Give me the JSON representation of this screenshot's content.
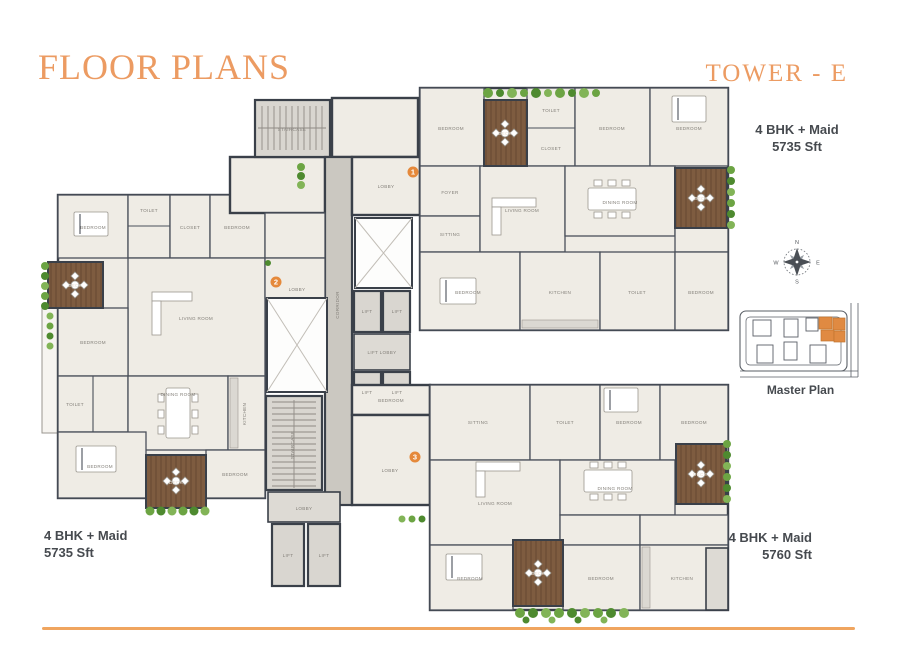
{
  "page": {
    "title": "FLOOR PLANS",
    "tower_title": "TOWER - E"
  },
  "unit_labels": {
    "top_right": {
      "type": "4 BHK + Maid",
      "area": "5735 Sft"
    },
    "bottom_left": {
      "type": "4 BHK + Maid",
      "area": "5735 Sft"
    },
    "bottom_right": {
      "type": "4 BHK + Maid",
      "area": "5760 Sft"
    }
  },
  "master_plan": {
    "caption": "Master Plan"
  },
  "compass": {
    "north": "N",
    "east": "E",
    "south": "S",
    "west": "W"
  },
  "plan": {
    "unit_markers": [
      {
        "label": "1",
        "x": 413,
        "y": 172
      },
      {
        "label": "2",
        "x": 276,
        "y": 282
      },
      {
        "label": "3",
        "x": 415,
        "y": 457
      }
    ],
    "room_labels": [
      {
        "t": "STAIRCASE",
        "x": 292,
        "y": 131
      },
      {
        "t": "CORRIDOR",
        "x": 339,
        "y": 305,
        "r": -90
      },
      {
        "t": "LOBBY",
        "x": 386,
        "y": 188
      },
      {
        "t": "LIFT",
        "x": 367,
        "y": 313
      },
      {
        "t": "LIFT",
        "x": 397,
        "y": 313
      },
      {
        "t": "LIFT LOBBY",
        "x": 382,
        "y": 354
      },
      {
        "t": "LIFT",
        "x": 367,
        "y": 394
      },
      {
        "t": "LIFT",
        "x": 397,
        "y": 394
      },
      {
        "t": "LOBBY",
        "x": 297,
        "y": 291
      },
      {
        "t": "STAIRCASE",
        "x": 294,
        "y": 445,
        "r": -90
      },
      {
        "t": "LOBBY",
        "x": 304,
        "y": 510
      },
      {
        "t": "LIFT",
        "x": 288,
        "y": 557
      },
      {
        "t": "LIFT",
        "x": 324,
        "y": 557
      },
      {
        "t": "LOBBY",
        "x": 390,
        "y": 472
      },
      {
        "t": "BEDROOM",
        "x": 451,
        "y": 130
      },
      {
        "t": "DECK",
        "x": 505,
        "y": 135,
        "s": "onwood"
      },
      {
        "t": "TOILET",
        "x": 551,
        "y": 112
      },
      {
        "t": "CLOSET",
        "x": 551,
        "y": 150
      },
      {
        "t": "BEDROOM",
        "x": 612,
        "y": 130
      },
      {
        "t": "BEDROOM",
        "x": 689,
        "y": 130
      },
      {
        "t": "FOYER",
        "x": 450,
        "y": 194
      },
      {
        "t": "SITTING",
        "x": 450,
        "y": 236
      },
      {
        "t": "LIVING ROOM",
        "x": 522,
        "y": 212
      },
      {
        "t": "DINING ROOM",
        "x": 620,
        "y": 204
      },
      {
        "t": "DECK",
        "x": 701,
        "y": 200,
        "s": "onwood"
      },
      {
        "t": "BEDROOM",
        "x": 468,
        "y": 294
      },
      {
        "t": "KITCHEN",
        "x": 560,
        "y": 294
      },
      {
        "t": "TOILET",
        "x": 637,
        "y": 294
      },
      {
        "t": "BEDROOM",
        "x": 701,
        "y": 294
      },
      {
        "t": "BEDROOM",
        "x": 93,
        "y": 229
      },
      {
        "t": "TOILET",
        "x": 149,
        "y": 212
      },
      {
        "t": "CLOSET",
        "x": 190,
        "y": 229
      },
      {
        "t": "BEDROOM",
        "x": 237,
        "y": 229
      },
      {
        "t": "DECK",
        "x": 75,
        "y": 287,
        "s": "onwood"
      },
      {
        "t": "LIVING ROOM",
        "x": 196,
        "y": 320
      },
      {
        "t": "BEDROOM",
        "x": 93,
        "y": 344
      },
      {
        "t": "TOILET",
        "x": 75,
        "y": 406
      },
      {
        "t": "DINING ROOM",
        "x": 178,
        "y": 396
      },
      {
        "t": "KITCHEN",
        "x": 246,
        "y": 414,
        "r": -90
      },
      {
        "t": "BEDROOM",
        "x": 100,
        "y": 468
      },
      {
        "t": "DECK",
        "x": 176,
        "y": 484,
        "s": "onwood"
      },
      {
        "t": "BEDROOM",
        "x": 235,
        "y": 476
      },
      {
        "t": "BEDROOM",
        "x": 391,
        "y": 402
      },
      {
        "t": "SITTING",
        "x": 478,
        "y": 424
      },
      {
        "t": "TOILET",
        "x": 565,
        "y": 424
      },
      {
        "t": "BEDROOM",
        "x": 629,
        "y": 424
      },
      {
        "t": "BEDROOM",
        "x": 694,
        "y": 424
      },
      {
        "t": "LIVING ROOM",
        "x": 495,
        "y": 505
      },
      {
        "t": "DINING ROOM",
        "x": 615,
        "y": 490
      },
      {
        "t": "DECK",
        "x": 700,
        "y": 476,
        "s": "onwood"
      },
      {
        "t": "BEDROOM",
        "x": 470,
        "y": 580
      },
      {
        "t": "DECK",
        "x": 538,
        "y": 575,
        "s": "onwood"
      },
      {
        "t": "BEDROOM",
        "x": 601,
        "y": 580
      },
      {
        "t": "KITCHEN",
        "x": 682,
        "y": 580
      }
    ]
  },
  "colors": {
    "accent": "#EC9B62",
    "wall": "#3A4049",
    "deck_wood": "#7E5C40",
    "greenery": "#6CA443",
    "tower_highlight": "#E08A42",
    "label_text": "#464A4F",
    "divider": "#F0A55F",
    "marker": "#E5893B"
  }
}
